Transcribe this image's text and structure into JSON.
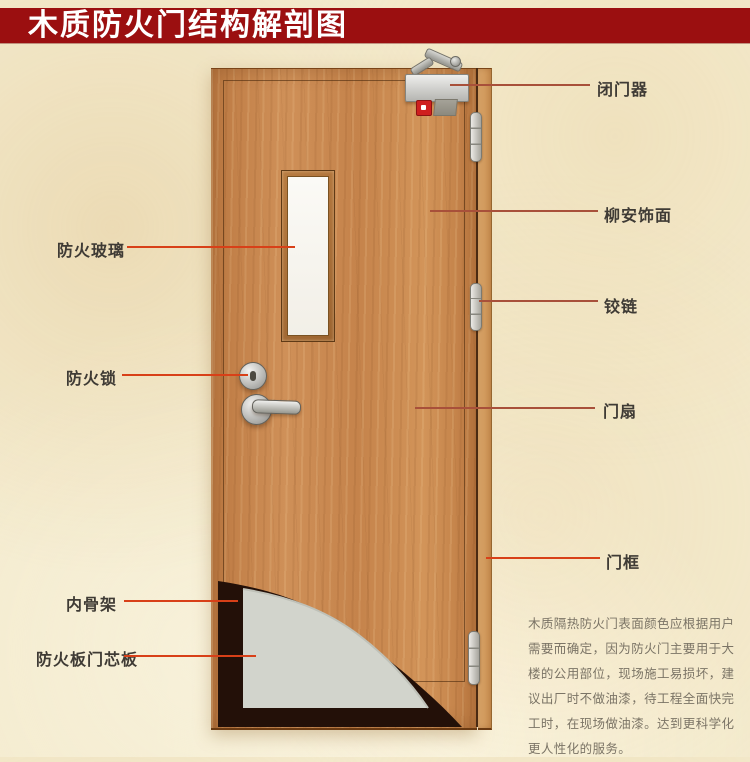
{
  "title": "木质防火门结构解剖图",
  "colors": {
    "banner": "#9b0f10",
    "banner_text": "#ffffff",
    "background": "#f4ebce",
    "label_text": "#3f3b35",
    "leader_left": "#d84018",
    "leader_right": "#a8503a",
    "glass": "#f2efe7",
    "core_grey": "#d2d4cc",
    "skeleton_dark": "#231008",
    "indicator_red": "#cf1f1f",
    "note_text": "#7b7466"
  },
  "labels": {
    "left": [
      {
        "id": "fire-glass",
        "text": "防火玻璃"
      },
      {
        "id": "fire-lock",
        "text": "防火锁"
      },
      {
        "id": "inner-skeleton",
        "text": "内骨架"
      },
      {
        "id": "fire-board-core",
        "text": "防火板门芯板"
      }
    ],
    "right": [
      {
        "id": "door-closer",
        "text": "闭门器"
      },
      {
        "id": "lauan-veneer",
        "text": "柳安饰面"
      },
      {
        "id": "hinge",
        "text": "铰链"
      },
      {
        "id": "door-leaf",
        "text": "门扇"
      },
      {
        "id": "door-frame",
        "text": "门框"
      }
    ]
  },
  "note": {
    "lines": [
      "木质隔热防火门表面颜色应根据用户",
      "需要而确定，因为防火门主要用于大",
      "楼的公用部位，现场施工易损坏，建",
      "议出厂时不做油漆，待工程全面快完",
      "工时，在现场做油漆。达到更科学化",
      "更人性化的服务。"
    ]
  }
}
